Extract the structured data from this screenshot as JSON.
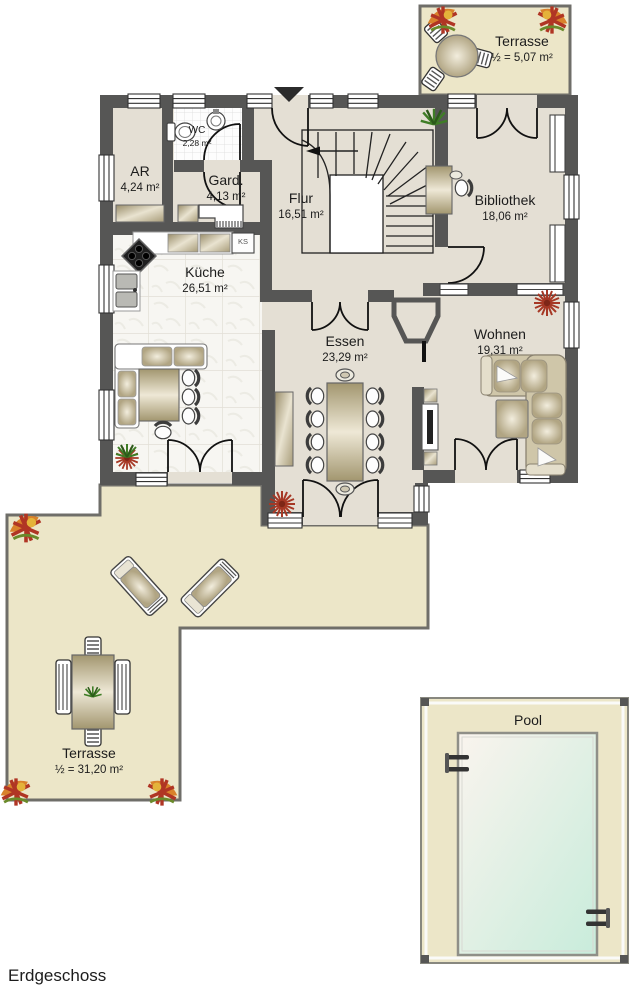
{
  "floor_label": "Erdgeschoss",
  "rooms": {
    "wc": {
      "name": "WC",
      "area": "2,28 m²"
    },
    "ar": {
      "name": "AR",
      "area": "4,24 m²"
    },
    "gard": {
      "name": "Gard.",
      "area": "4,13 m²"
    },
    "flur": {
      "name": "Flur",
      "area": "16,51 m²"
    },
    "bibliothek": {
      "name": "Bibliothek",
      "area": "18,06 m²"
    },
    "kueche": {
      "name": "Küche",
      "area": "26,51 m²"
    },
    "essen": {
      "name": "Essen",
      "area": "23,29 m²"
    },
    "wohnen": {
      "name": "Wohnen",
      "area": "19,31 m²"
    }
  },
  "terrace_top": {
    "name": "Terrasse",
    "area": "½ = 5,07 m²"
  },
  "terrace_main": {
    "name": "Terrasse",
    "area": "½ = 31,20 m²"
  },
  "pool": {
    "label": "Pool"
  },
  "kitchen": {
    "fridge_label": "KS"
  },
  "colors": {
    "wall": "#565655",
    "interior_floor": "#e4dfd4",
    "terrace": "#ece6c8",
    "kitchen_tile": "#f7f6f2",
    "pool_water_start": "#faf4ee",
    "pool_water_end": "#c8ecdb",
    "furniture_tan": "#b3a685",
    "decor_red": "#a63825",
    "decor_orange": "#d9822b",
    "plant_green": "#3f7d26"
  }
}
